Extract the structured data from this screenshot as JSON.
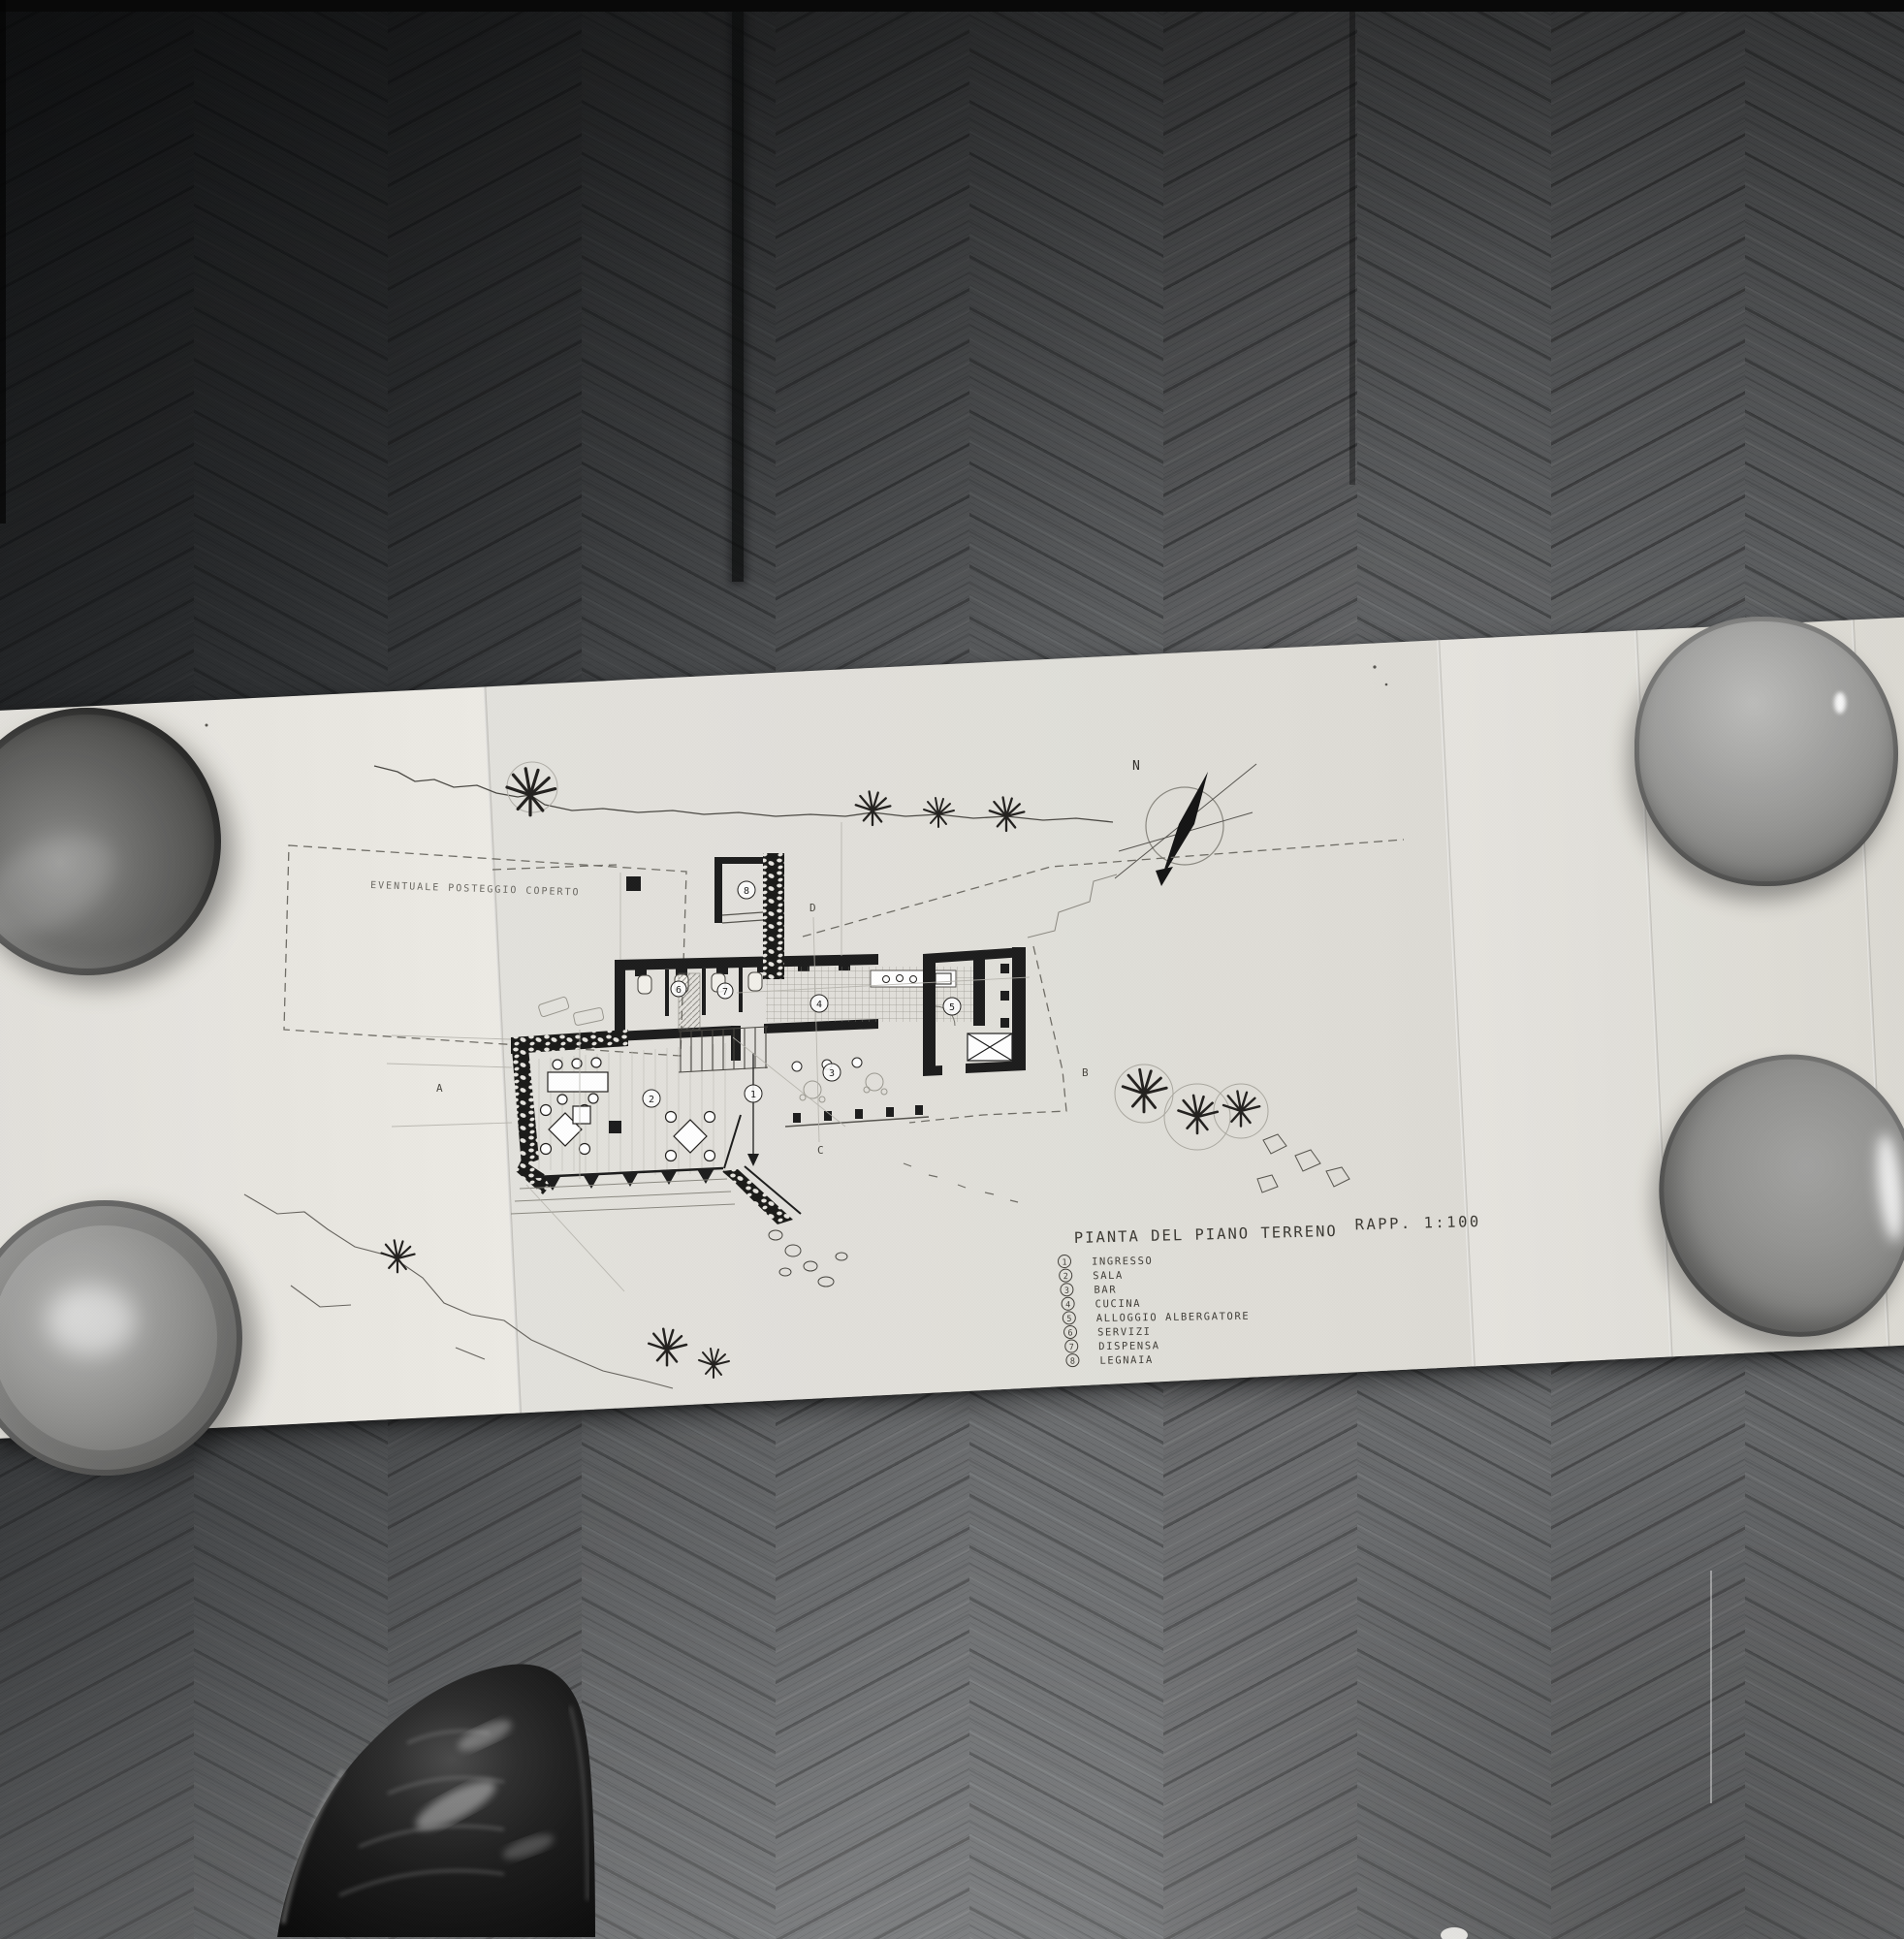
{
  "scene": {
    "type": "black-and-white photograph",
    "subject": "Hand-drawn architectural ground-floor plan on a long folded sheet, laid on herringbone parquet, corners weighted with four ceramic bowls, photographer's black leather shoe at bottom edge"
  },
  "drawing": {
    "title": "PIANTA DEL PIANO TERRENO",
    "scale_label": "RAPP. 1:100",
    "parking_note": "EVENTUALE POSTEGGIO COPERTO",
    "compass_label": "N",
    "section_markers": [
      "A",
      "B",
      "C",
      "D"
    ],
    "rooms": [
      {
        "number": "1",
        "name": "INGRESSO"
      },
      {
        "number": "2",
        "name": "SALA"
      },
      {
        "number": "3",
        "name": "BAR"
      },
      {
        "number": "4",
        "name": "CUCINA"
      },
      {
        "number": "5",
        "name": "ALLOGGIO ALBERGATORE"
      },
      {
        "number": "6",
        "name": "SERVIZI"
      },
      {
        "number": "7",
        "name": "DISPENSA"
      },
      {
        "number": "8",
        "name": "LEGNAIA"
      }
    ]
  },
  "colors": {
    "paper": "#e9e7e1",
    "floor_dark": "#303234",
    "floor_mid": "#636567",
    "floor_light": "#7e8082",
    "ink": "#1c1c1c",
    "pencil": "#b3b1aa",
    "bowl_gray": "#8e8e8c",
    "shoe_black": "#121212"
  }
}
